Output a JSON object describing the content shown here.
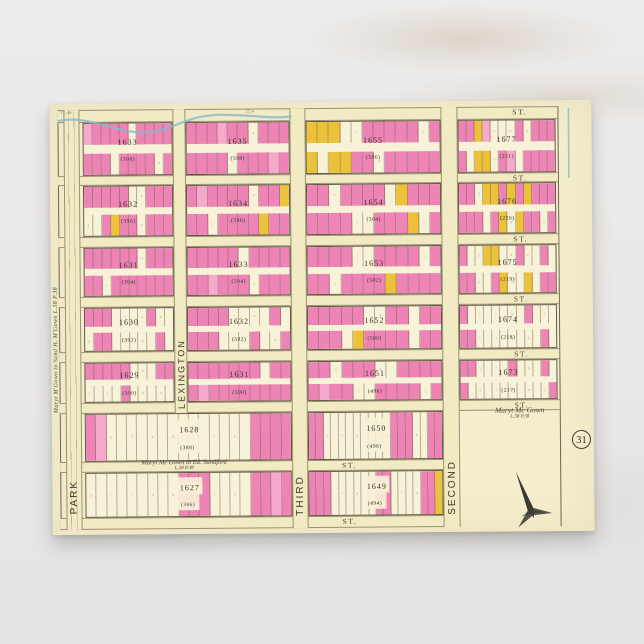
{
  "colors": {
    "pink": "#ee84b5",
    "pink_light": "#f6a9ca",
    "yellow": "#ecc23a",
    "cream": "#f5eecd",
    "ink": "#3f3b30",
    "blue": "#86b9cd"
  },
  "postcard": {
    "plate_number": "31"
  },
  "map": {
    "street_label": "ST.",
    "avenues": [
      {
        "id": "park",
        "label": "PARK"
      },
      {
        "id": "lexington",
        "label": "LEXINGTON"
      },
      {
        "id": "third",
        "label": "THIRD"
      },
      {
        "id": "second",
        "label": "SECOND"
      }
    ],
    "streets": [
      {
        "id": "s0",
        "label": "ST."
      },
      {
        "id": "s1",
        "label": "ST."
      },
      {
        "id": "s2",
        "label": "ST."
      },
      {
        "id": "s3",
        "label": "ST."
      },
      {
        "id": "s4",
        "label": "ST."
      },
      {
        "id": "s5",
        "label": "ST."
      },
      {
        "id": "s6",
        "label": "ST."
      },
      {
        "id": "s7",
        "label": "ST."
      }
    ],
    "blocks": [
      {
        "id": "A1",
        "col": "A",
        "row": 1,
        "number": "1633",
        "sub": "(398)",
        "top": "pPPPPWPPPP",
        "bottom": "PPPWPPPPWP"
      },
      {
        "id": "A2",
        "col": "A",
        "row": 2,
        "number": "1632",
        "sub": "(396)",
        "top": "PPPPPWWPPP",
        "bottom": "WWPYPPWPPP"
      },
      {
        "id": "A3",
        "col": "A",
        "row": 3,
        "number": "1631",
        "sub": "(394)",
        "top": "PPPPPPWPPP",
        "bottom": "PPWPPPPPPP"
      },
      {
        "id": "A4",
        "col": "A",
        "row": 4,
        "number": "1630",
        "sub": "(392)",
        "top": "PPPWWWWPWW",
        "bottom": "WPPWWWWWPW"
      },
      {
        "id": "A5",
        "col": "A",
        "row": 5,
        "number": "1629",
        "sub": "(390)",
        "top": "PPPPPWWWPP",
        "bottom": "WWWWPWWWWW"
      },
      {
        "id": "B1",
        "col": "B",
        "row": 1,
        "number": "1635",
        "sub": "(598)",
        "top": "PPPpPPWPPP",
        "bottom": "PPPPWPPPpP"
      },
      {
        "id": "B2",
        "col": "B",
        "row": 2,
        "number": "1634",
        "sub": "(596)",
        "top": "PpPPPPWPPY",
        "bottom": "PPWPPPPYPP"
      },
      {
        "id": "B3",
        "col": "B",
        "row": 3,
        "number": "1633",
        "sub": "(594)",
        "top": "PPPPPWPPPP",
        "bottom": "PPpPPPWPPP"
      },
      {
        "id": "B4",
        "col": "B",
        "row": 4,
        "number": "1632",
        "sub": "(592)",
        "top": "PPPPWWWWPW",
        "bottom": "PPPWWWPWWP"
      },
      {
        "id": "B5",
        "col": "B",
        "row": 5,
        "number": "1631",
        "sub": "(590)",
        "top": "PPPPPPPWPP",
        "bottom": "PpPPPPPPPP"
      },
      {
        "id": "C1",
        "col": "C",
        "row": 1,
        "number": "1655",
        "sub": "(506)",
        "top": "YYYWWPPPPPWP",
        "bottom": "YWYYPPWPPPPP"
      },
      {
        "id": "C2",
        "col": "C",
        "row": 2,
        "number": "1654",
        "sub": "(504)",
        "top": "PPWPPPPWYPPP",
        "bottom": "PPPPWWPPPYWP"
      },
      {
        "id": "C3",
        "col": "C",
        "row": 3,
        "number": "1653",
        "sub": "(502)",
        "top": "PPPPWWPPPPWP",
        "bottom": "PPWPPPPYPPPP"
      },
      {
        "id": "C4",
        "col": "C",
        "row": 4,
        "number": "1652",
        "sub": "(500)",
        "top": "PPPPPWWPPWPP",
        "bottom": "PPPWYPPPPWPP"
      },
      {
        "id": "C5",
        "col": "C",
        "row": 5,
        "number": "1651",
        "sub": "(498)",
        "top": "PPWPPPWWPPPP",
        "bottom": "PpPPWWPPPPWP"
      },
      {
        "id": "C6",
        "col": "C",
        "row": 6,
        "number": "1650",
        "sub": "(496)",
        "lots": "PPWWWWWWWWWPPPWWPP"
      },
      {
        "id": "C7",
        "col": "C",
        "row": 7,
        "number": "1649",
        "sub": "(494)",
        "lots": "PPPWWWWWWPPWWWWPPY"
      },
      {
        "id": "D1",
        "col": "D",
        "row": 1,
        "number": "1677",
        "sub": "(221)",
        "top": "PPYpWWWPWPPP",
        "bottom": "PWYYWPpWPPPP"
      },
      {
        "id": "D2",
        "col": "D",
        "row": 2,
        "number": "1676",
        "sub": "(220)",
        "top": "PPWYYPYPYPPP",
        "bottom": "PPPWPYWYPPWP"
      },
      {
        "id": "D3",
        "col": "D",
        "row": 3,
        "number": "1675",
        "sub": "(219)",
        "top": "PWWYYWWPWWPW",
        "bottom": "PPWWPYWWYWPP"
      },
      {
        "id": "D4",
        "col": "D",
        "row": 4,
        "number": "1674",
        "sub": "(218)",
        "top": "PWWWWWWWPWWW",
        "bottom": "PPWWWWWWWWPW"
      },
      {
        "id": "D5",
        "col": "D",
        "row": 5,
        "number": "1673",
        "sub": "(217)",
        "top": "PPWWWWPWWWPW",
        "bottom": "PWWWWWWWWWWP"
      },
      {
        "id": "AB6",
        "col": "AB",
        "row": 6,
        "number": "1628",
        "sub": "(388)",
        "lots": "PpWWWWWWWWWWWWWWPPPP"
      },
      {
        "id": "AB7",
        "col": "AB",
        "row": 7,
        "number": "1627",
        "sub": "(386)",
        "lots": "WWWWWWWWWPPPWWWWPPpP"
      }
    ],
    "annotations": {
      "margin_deed": "Maryt M'Gown to Saml H. M'Gown  L.38 P.38",
      "sandford_deed_line1": "Maryt Mc Gown to Ed. Sandford",
      "sandford_deed_line2": "L.38 P.38",
      "estate_line1": "Maryt Mc Gown",
      "estate_line2": "L.38 P.38",
      "edge_number_left": "11.46",
      "edge_number_mid": "25.4"
    }
  }
}
